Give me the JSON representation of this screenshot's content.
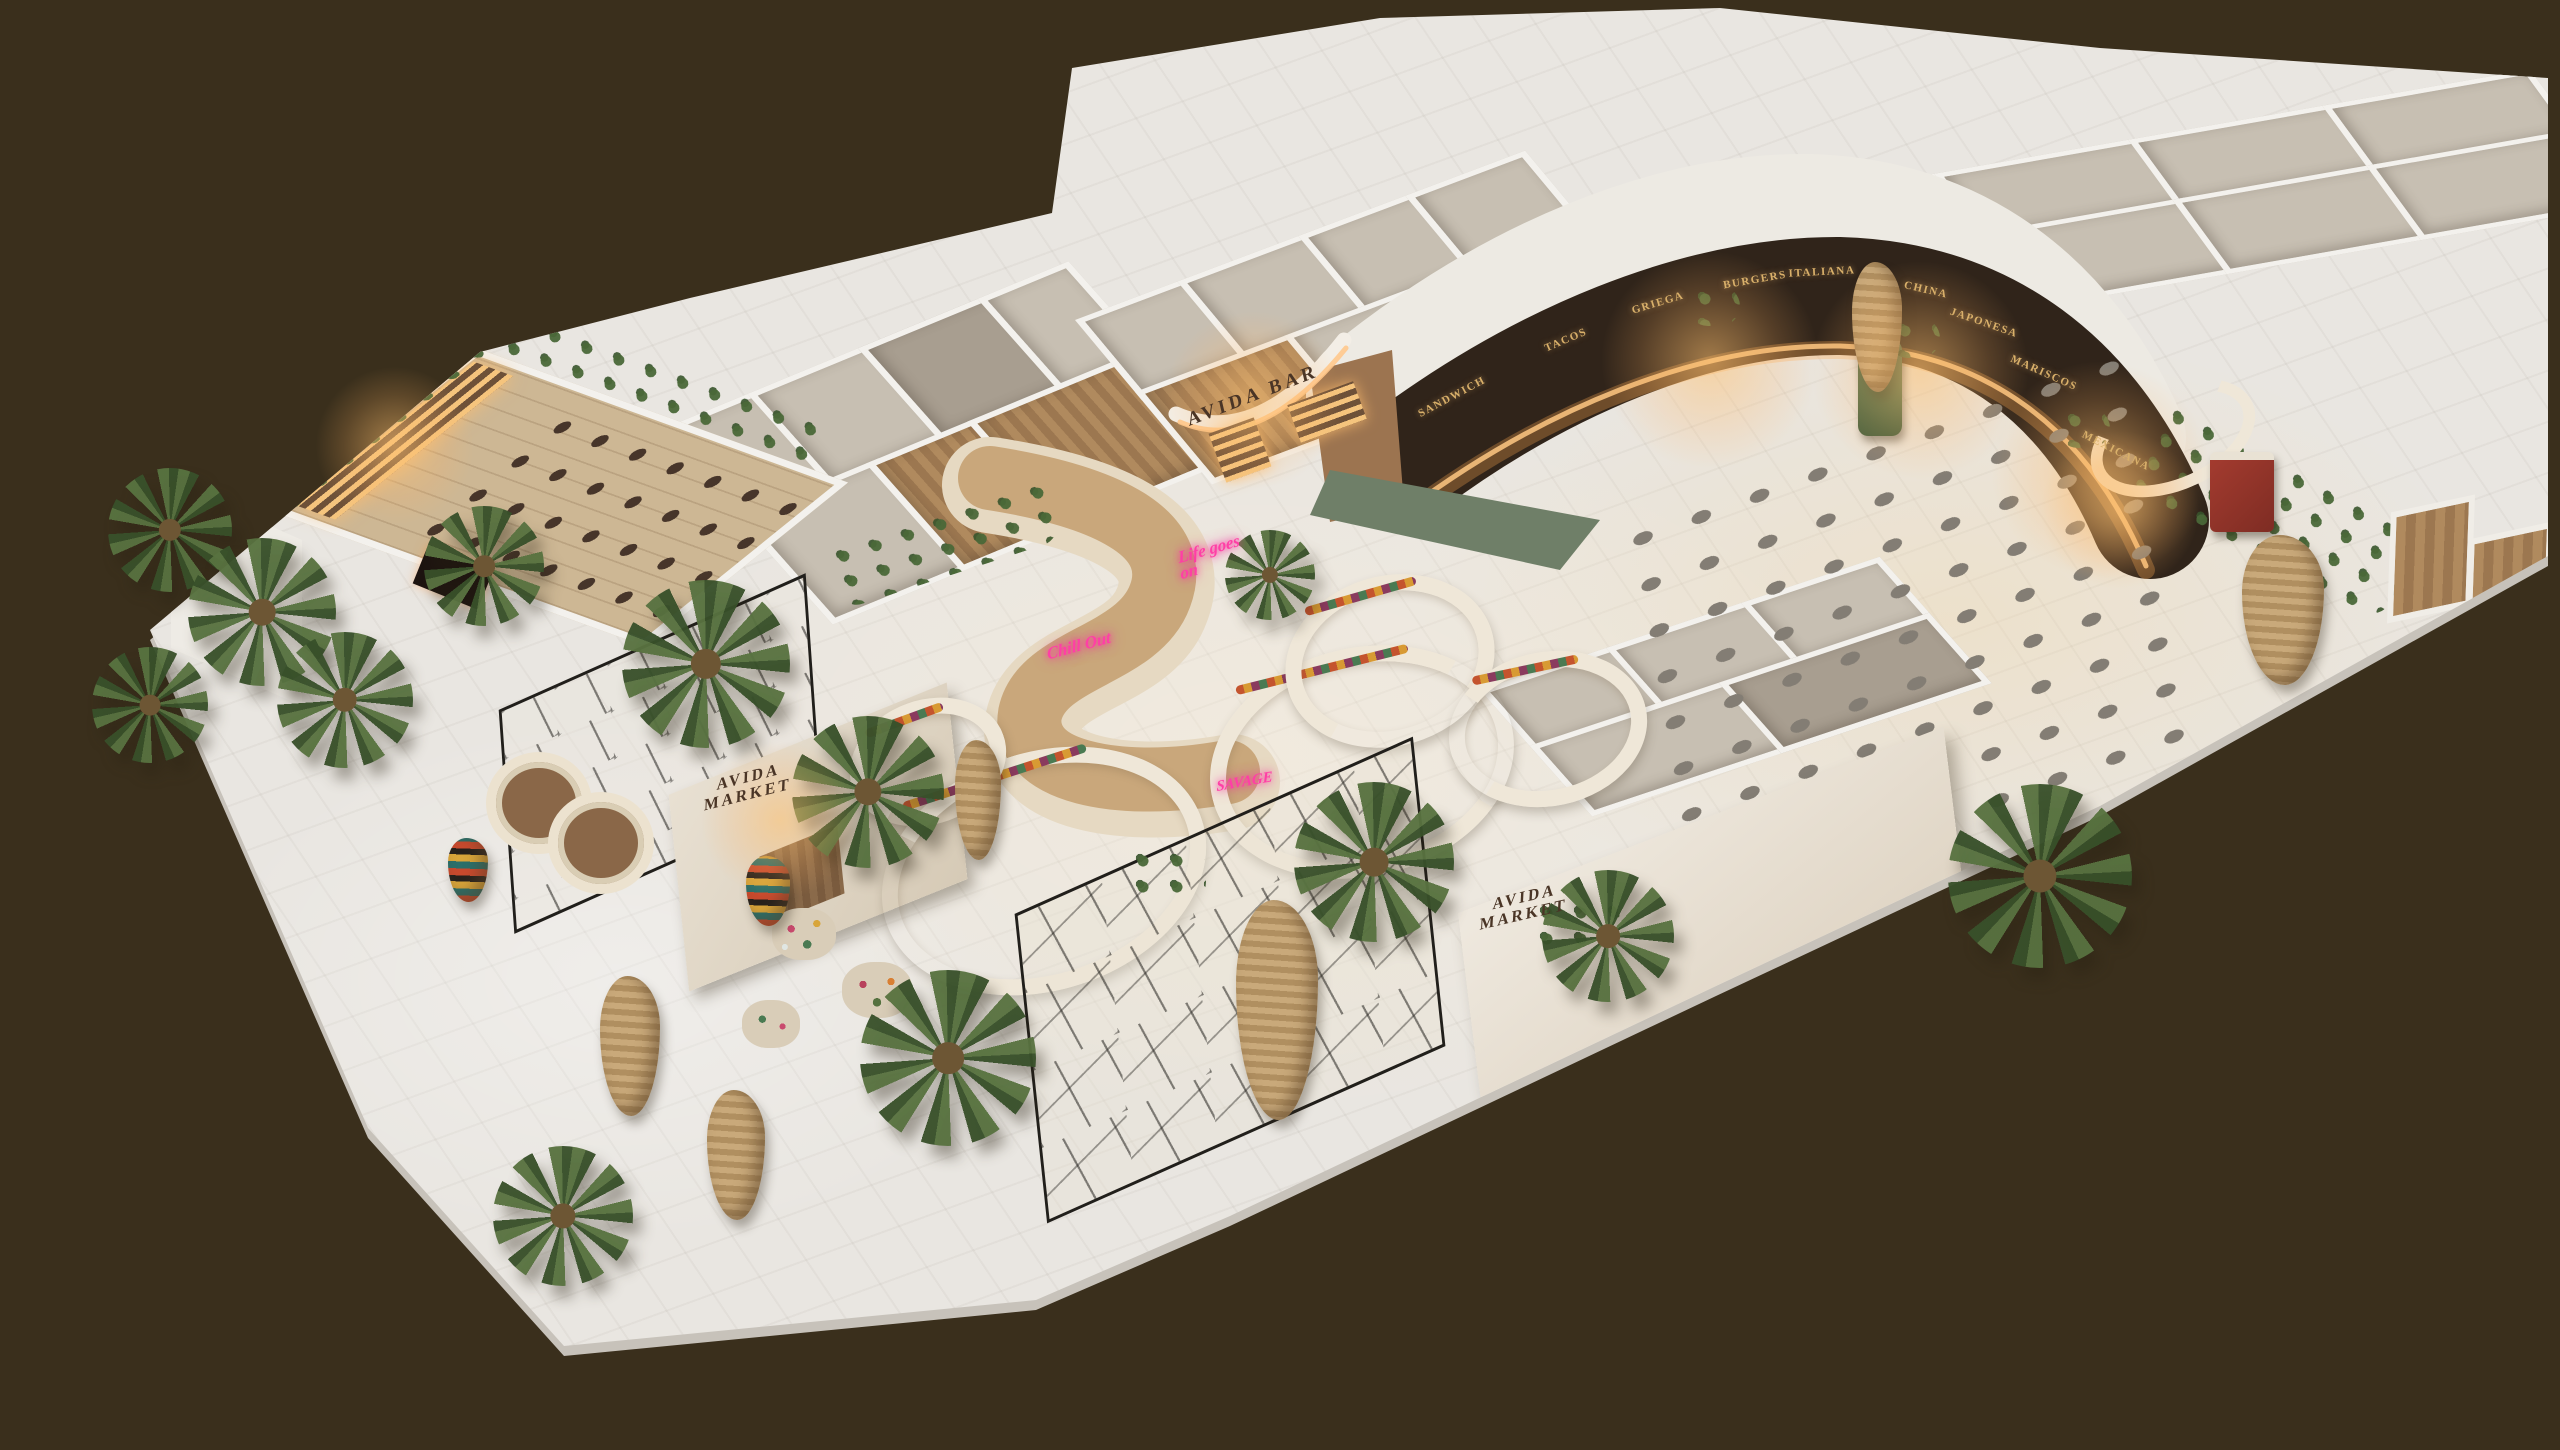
{
  "scene": {
    "title": "AVIDA food hall — isometric 3D floor plan render",
    "background_color": "#3a2f1c",
    "floor_color": "#e9e6e1",
    "neon_color": "#ff3fa6",
    "sign_color": "#4a3526"
  },
  "brand": {
    "bar_sign": "AVIDA BAR",
    "market_sign_line1": "AVIDA",
    "market_sign_line2": "MARKET"
  },
  "neon_signs": [
    {
      "label": "Life goes on"
    },
    {
      "label": "Chill Out"
    },
    {
      "label": "SAVAGE"
    }
  ],
  "stalls": [
    {
      "label": "SANDWICH"
    },
    {
      "label": "TACOS"
    },
    {
      "label": "GRIEGA"
    },
    {
      "label": "BURGERS"
    },
    {
      "label": "ITALIANA"
    },
    {
      "label": "CHINA"
    },
    {
      "label": "JAPONESA"
    },
    {
      "label": "MARISCOS"
    },
    {
      "label": "MEXICANA"
    }
  ]
}
